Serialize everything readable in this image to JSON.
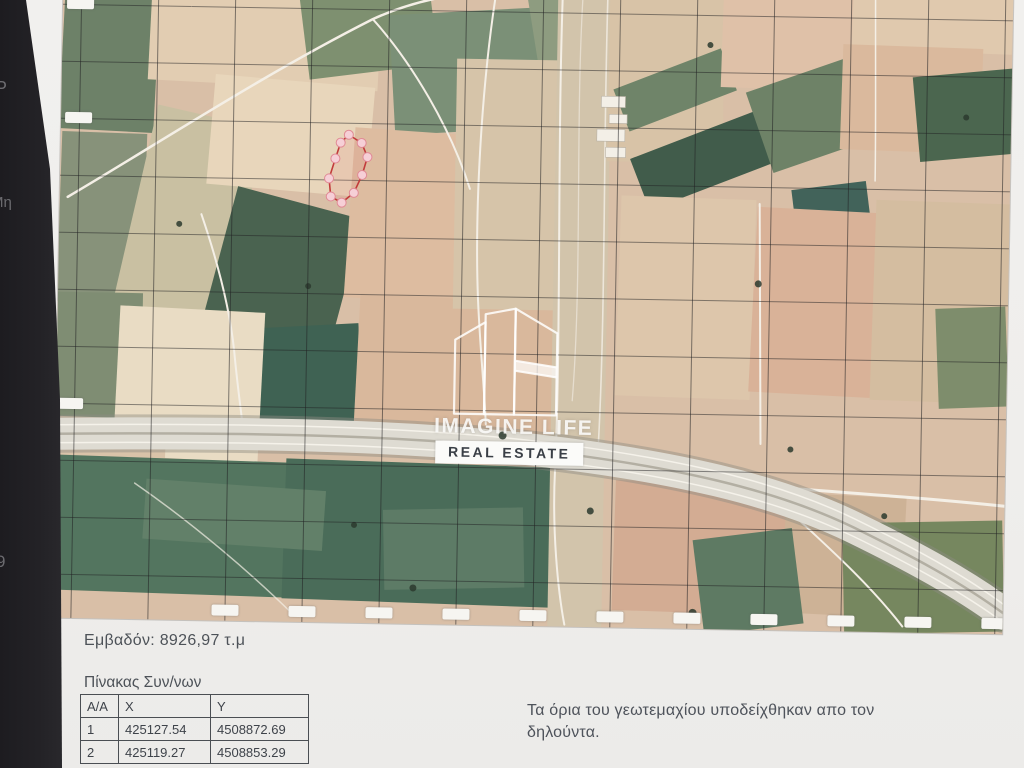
{
  "edge_fragments": {
    "f1": "Ρ",
    "f2": "Μη",
    "f3": "9"
  },
  "map": {
    "description": "aerial-orthophoto-with-coordinate-grid",
    "watermark_line1": "IMAGINE LIFE",
    "watermark_line2": "REAL ESTATE",
    "parcel_outline_color": "#c23b3b"
  },
  "details": {
    "area_label": "Εμβαδόν: 8926,97 τ.μ",
    "table_title": "Πίνακας Συν/νων",
    "note": "Τα όρια του γεωτεμαχίου υποδείχθηκαν απο τον δηλούντα."
  },
  "coords_table": {
    "headers": {
      "c1": "Α/Α",
      "c2": "X",
      "c3": "Y"
    },
    "rows": [
      {
        "id": "1",
        "x": "425127.54",
        "y": "4508872.69"
      },
      {
        "id": "2",
        "x": "425119.27",
        "y": "4508853.29"
      }
    ]
  }
}
